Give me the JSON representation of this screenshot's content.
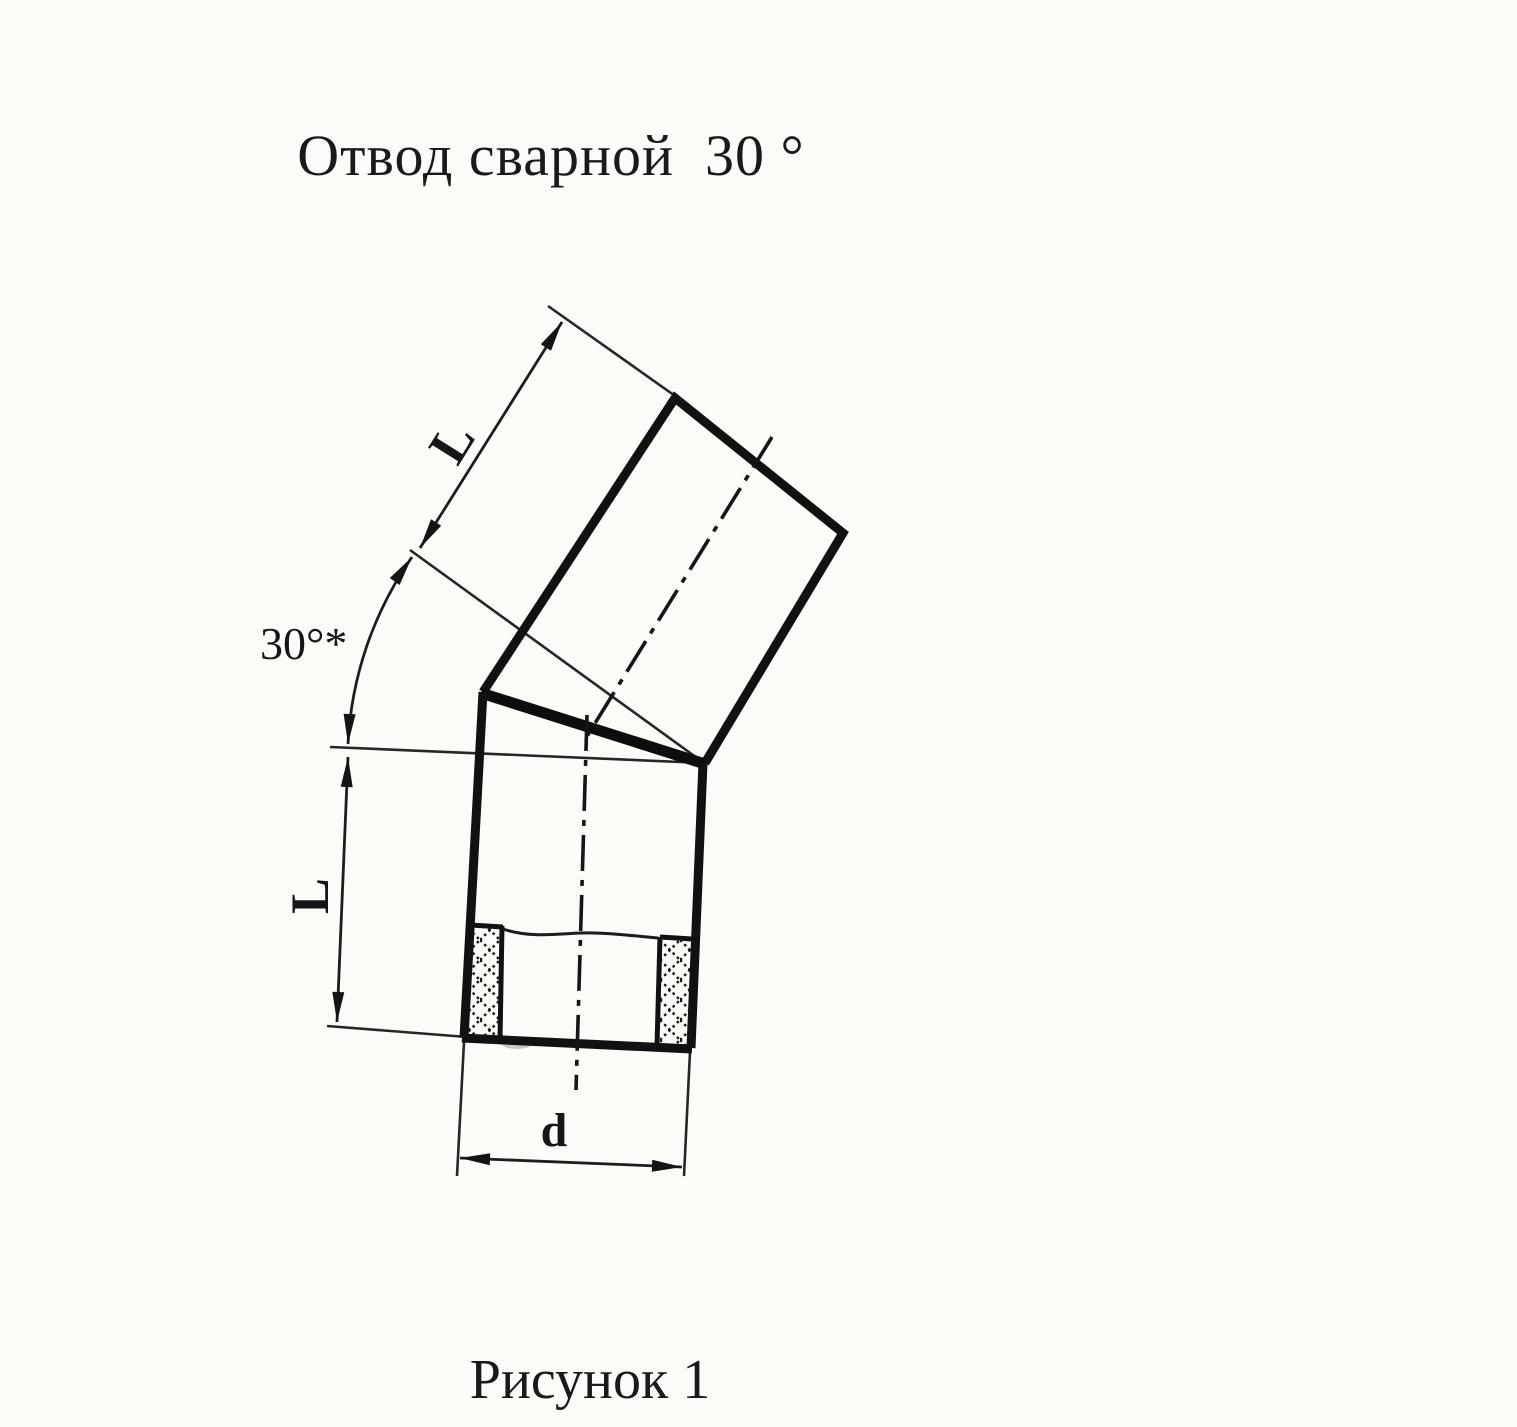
{
  "colors": {
    "paper": "#fbfbf8",
    "ink": "#1a1a1a"
  },
  "header": {
    "title": "Отвод сварной  30 °"
  },
  "drawing": {
    "kind": "welded-elbow-30deg",
    "labels": {
      "angle": "30°*",
      "length_upper": "L",
      "length_lower": "L",
      "diameter": "d"
    }
  },
  "footer": {
    "caption": "Рисунок 1"
  }
}
